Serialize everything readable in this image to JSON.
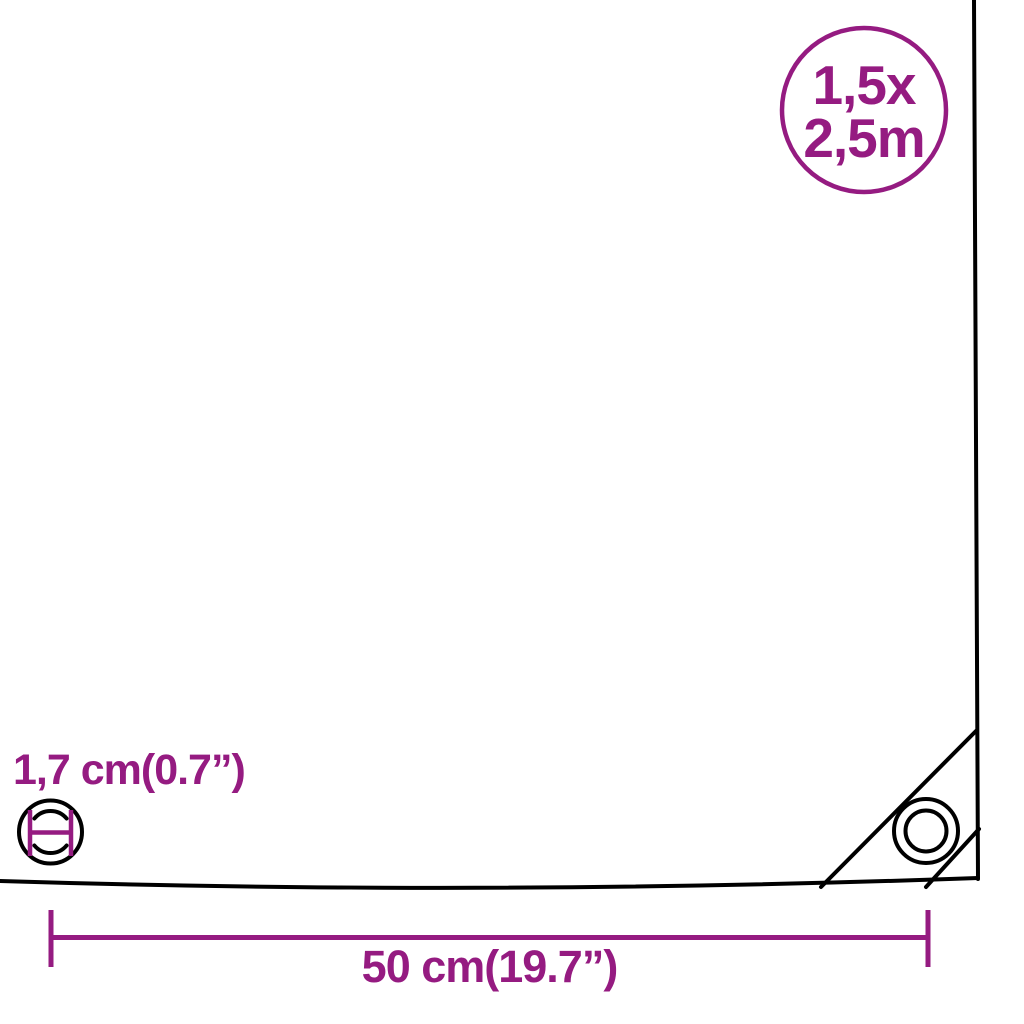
{
  "colors": {
    "accent": "#951b81",
    "line": "#000000",
    "background": "#ffffff"
  },
  "size_badge": {
    "line1": "1,5x",
    "line2": "2,5m"
  },
  "labels": {
    "grommet_diameter": "1,7 cm(0.7”)",
    "tarp_width": "50 cm(19.7”)"
  },
  "icons": {
    "corner_grommet": "concentric-rings-eyelet",
    "grommet_diameter_measure": "circle-with-diameter-measure",
    "width_dimension": "horizontal-measure-line-with-end-ticks"
  }
}
